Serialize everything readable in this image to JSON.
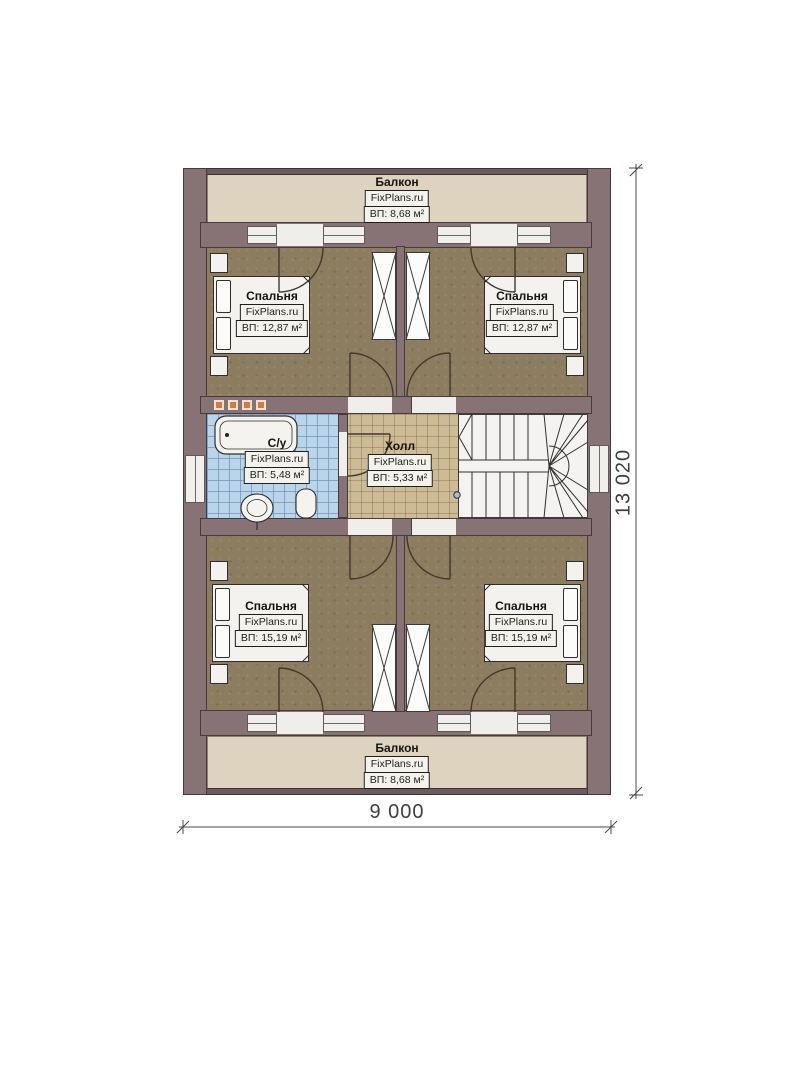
{
  "watermark": "FixPlans.ru",
  "dimensions": {
    "width": "9 000",
    "height": "13 020"
  },
  "rooms": {
    "balcony_top": {
      "name": "Балкон",
      "area": "ВП: 8,68 м²"
    },
    "bedroom_top_left": {
      "name": "Спальня",
      "area": "ВП: 12,87 м²"
    },
    "bedroom_top_right": {
      "name": "Спальня",
      "area": "ВП: 12,87 м²"
    },
    "bathroom": {
      "name": "С/у",
      "area": "ВП: 5,48 м²"
    },
    "hall": {
      "name": "Холл",
      "area": "ВП: 5,33 м²"
    },
    "bedroom_bottom_left": {
      "name": "Спальня",
      "area": "ВП: 15,19 м²"
    },
    "bedroom_bottom_right": {
      "name": "Спальня",
      "area": "ВП: 15,19 м²"
    },
    "balcony_bottom": {
      "name": "Балкон",
      "area": "ВП: 8,68 м²"
    }
  },
  "palette": {
    "wall": "#877276",
    "bedroom_floor": "#8c7c60",
    "hall_floor": "#cdbb96",
    "bathroom_floor": "#bad4ea",
    "balcony_floor": "#ded3be",
    "stairs": "#f4f3f1",
    "radiator_accent": "#e0763c"
  }
}
